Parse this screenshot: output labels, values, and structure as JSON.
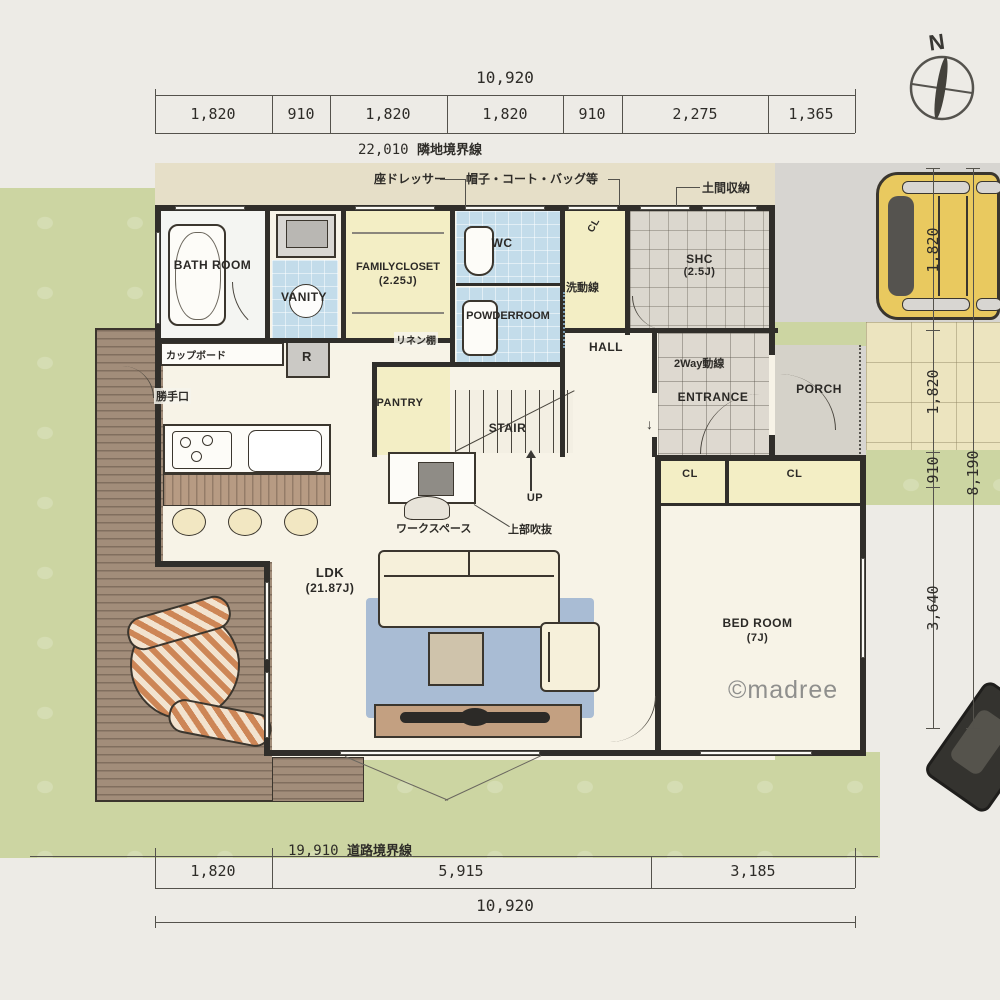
{
  "meta": {
    "watermark": "©madree",
    "compass_n": "N"
  },
  "dims": {
    "top": {
      "total": "10,920",
      "segments": [
        "1,820",
        "910",
        "1,820",
        "1,820",
        "910",
        "2,275",
        "1,365"
      ],
      "boundary_value": "22,010",
      "boundary_label": "隣地境界線"
    },
    "bottom": {
      "boundary_value": "19,910",
      "boundary_label": "道路境界線",
      "segments": [
        "1,820",
        "5,915",
        "3,185"
      ],
      "total": "10,920"
    },
    "right": {
      "segments": [
        "1,820",
        "1,820",
        "910"
      ],
      "overall": "8,190",
      "south": "3,640"
    }
  },
  "rooms": {
    "bath": "BATH ROOM",
    "vanity": "VANITY",
    "family_closet": "FAMILYCLOSET",
    "family_closet_size": "(2.25J)",
    "wc": "WC",
    "powder": "POWDERROOM",
    "shc": "SHC",
    "shc_size": "(2.5J)",
    "hall": "HALL",
    "entrance": "ENTRANCE",
    "porch": "PORCH",
    "stair": "STAIR",
    "up": "UP",
    "pantry": "PANTRY",
    "ldk": "LDK",
    "ldk_size": "(21.87J)",
    "bedroom": "BED ROOM",
    "bedroom_size": "(7J)",
    "closet_left": "CL",
    "closet_right": "CL",
    "closet_hall": "CL"
  },
  "annotations": {
    "dresser": "座ドレッサー",
    "coat_storage": "帽子・コート・バッグ等",
    "doma_storage": "土間収納",
    "cupboard": "カップボード",
    "fridge": "R",
    "back_door": "勝手口",
    "linen_shelf": "リネン棚",
    "wash_flow": "洗動線",
    "two_way_flow": "2Way動線",
    "workspace": "ワークスペース",
    "void_above": "上部吹抜"
  },
  "colors": {
    "lawn": "#ccd5a2",
    "deck_wood": "#a28d7a",
    "wet_tile_blue": "#c3dcea",
    "closet_yellow": "#f3eec5",
    "wall": "#302e2a",
    "rug_blue": "#a9bcd4",
    "car_yellow": "#e9c95f",
    "eave_tan": "#e6dfc8"
  }
}
